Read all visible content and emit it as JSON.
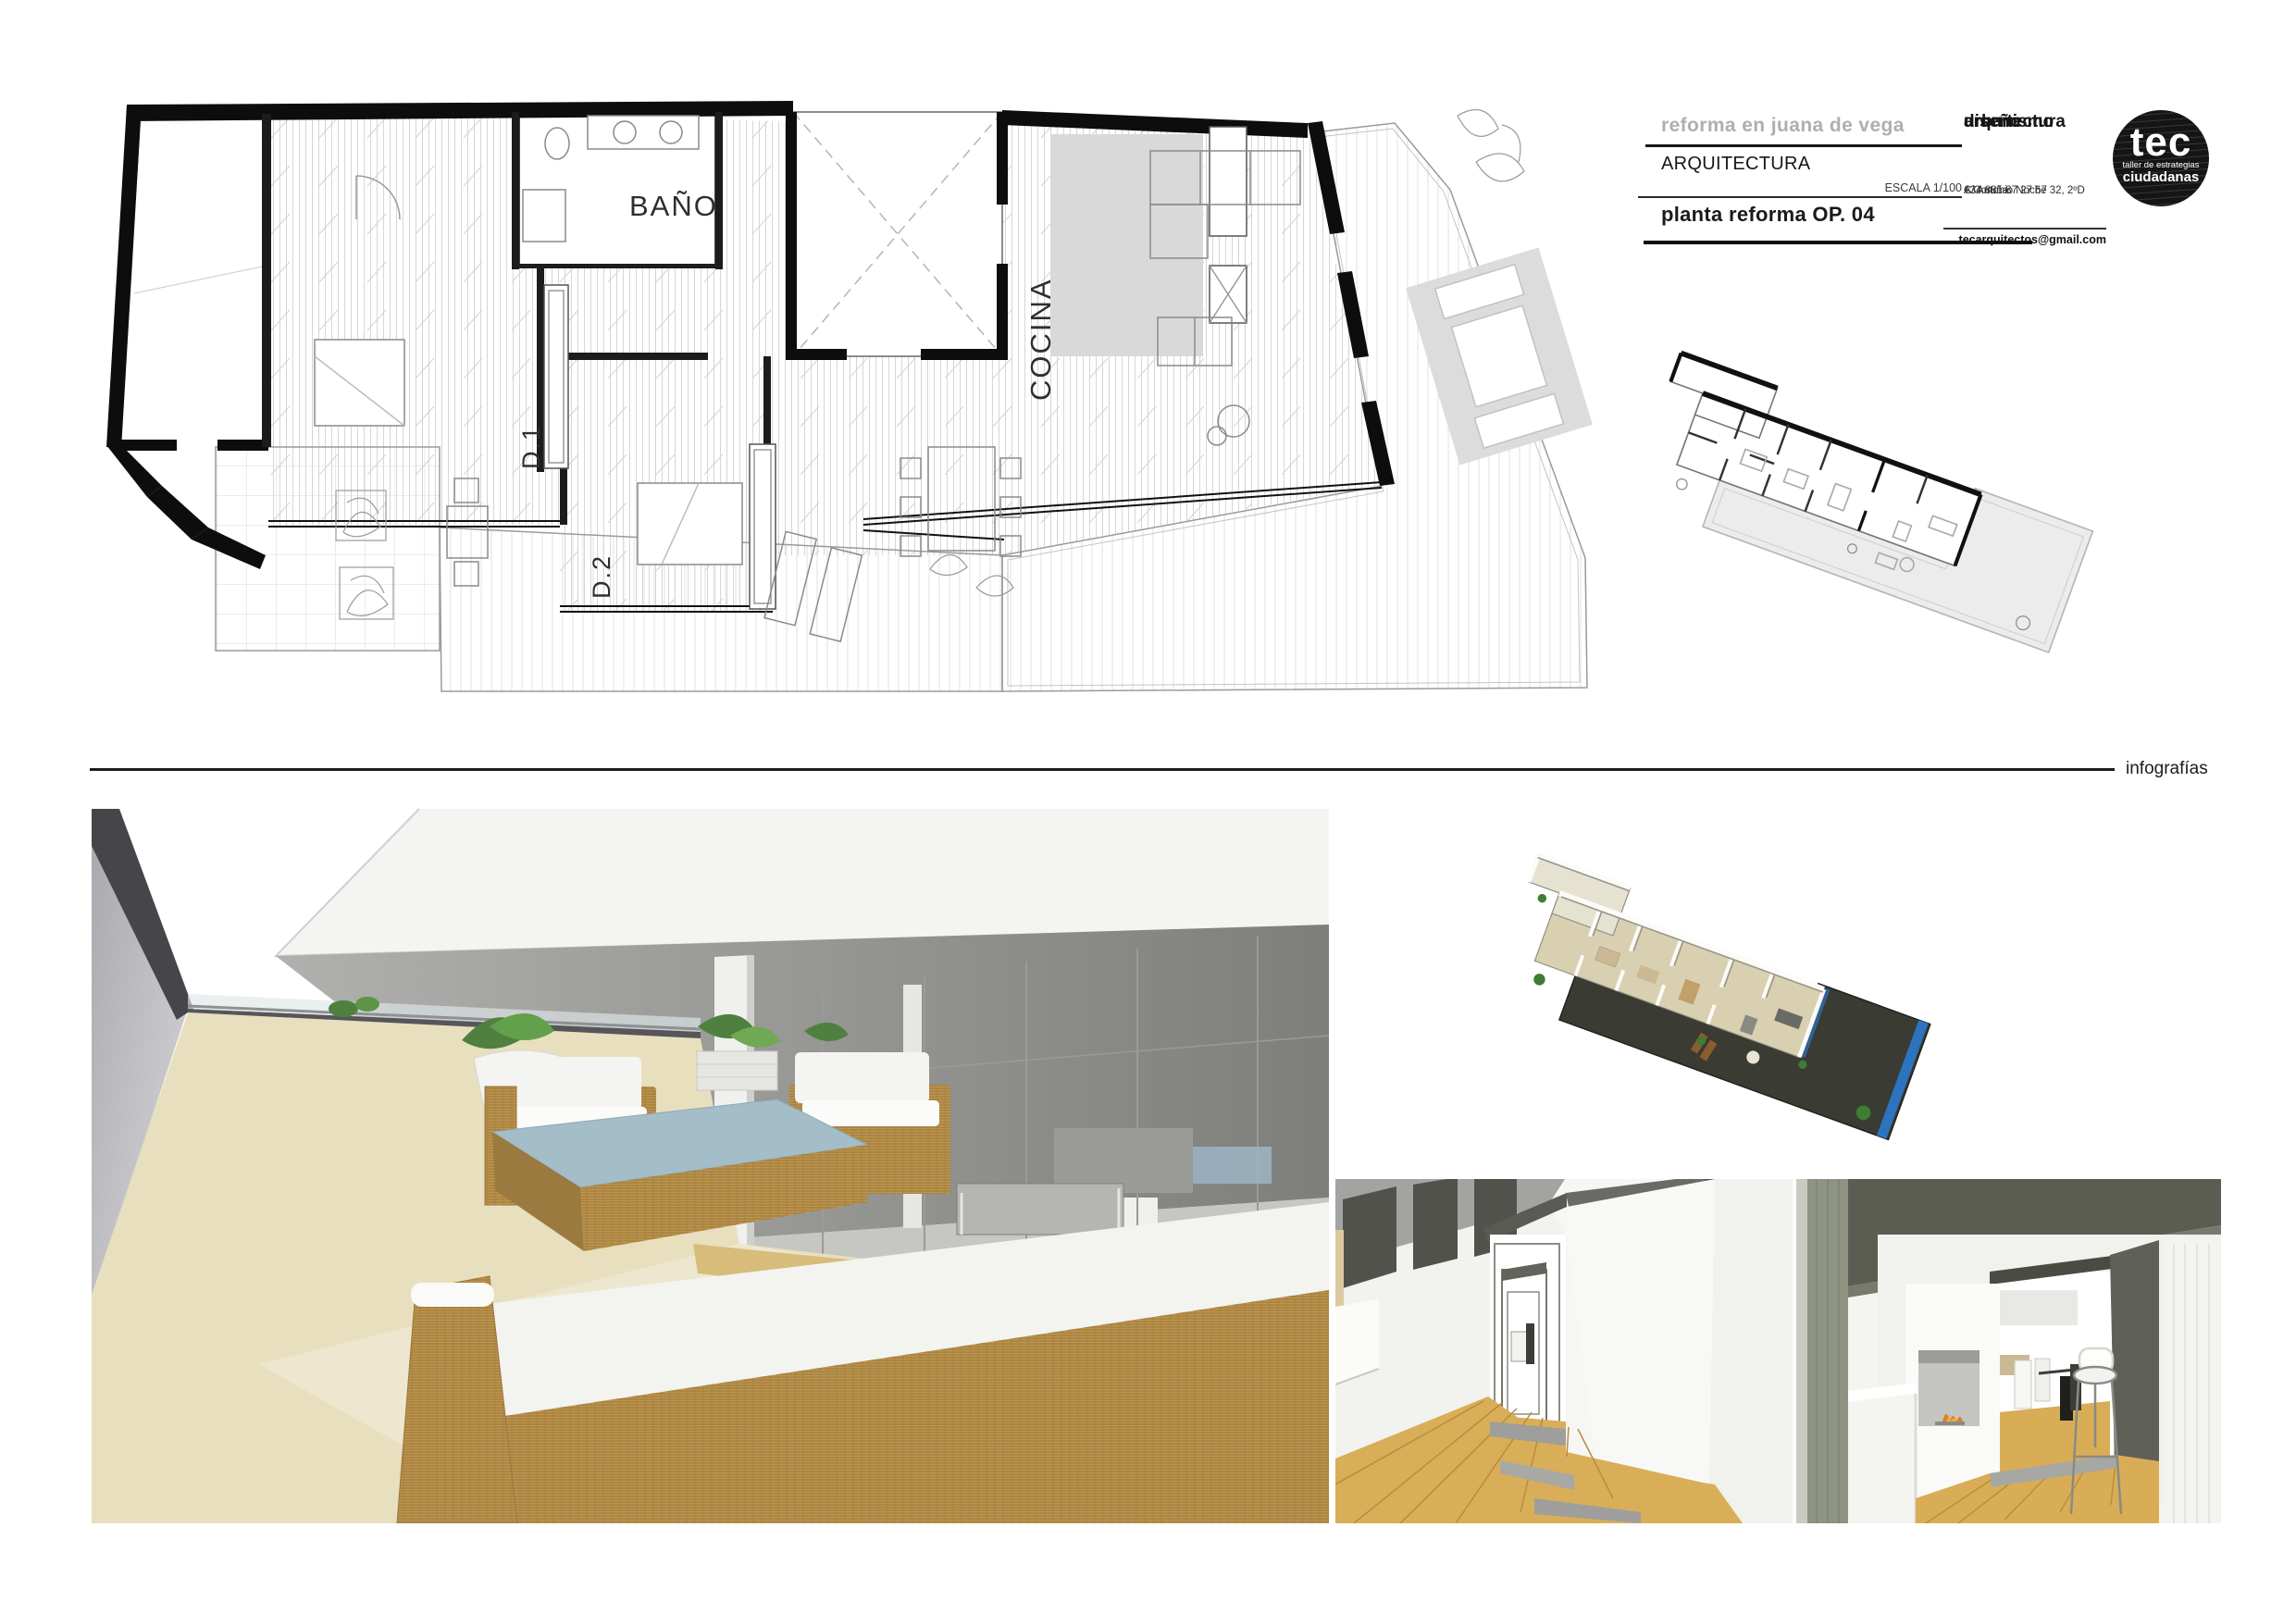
{
  "title_block": {
    "project_title": "reforma en juana de vega",
    "discipline": "ARQUITECTURA",
    "scale_label": "ESCALA 1/100",
    "sheet_title": "planta reforma OP. 04",
    "firm_service_1": "arquitectura",
    "firm_service_2": "urbanismo",
    "firm_service_3": "diseño",
    "address_line1": "C/ Antonio Noche 32, 2ºD",
    "address_line2": "A Coruña",
    "phone": "+34 881 87 27 67",
    "email": "tecarquitectos@gmail.com",
    "logo": {
      "name": "tec",
      "tagline1": "taller de estrategias",
      "tagline2": "ciudadanas"
    }
  },
  "floor_plan": {
    "labels": {
      "bathroom": "BAÑO",
      "kitchen": "COCINA",
      "bedroom_1": "D.1",
      "bedroom_2": "D.2"
    }
  },
  "section_divider": {
    "label": "infografías"
  },
  "colors": {
    "wall_black": "#0d0d0d",
    "hatch_gray": "#d6d6d6",
    "kitchen_gray": "#d9d9d9",
    "terrace_floor_cream": "#e8dfbe",
    "wicker_tan": "#bf9650",
    "cushion_white": "#f4f4f2",
    "coffee_table_blue": "#a3bdc9",
    "wood_floor": "#d9ae58",
    "plant_green": "#4f8040",
    "pool_blue": "#2e73bf",
    "ceiling_gray": "#8f8f8d",
    "column_green_gray": "#8e9382",
    "logo_black": "#151515",
    "muted_title_gray": "#b0aeae"
  }
}
